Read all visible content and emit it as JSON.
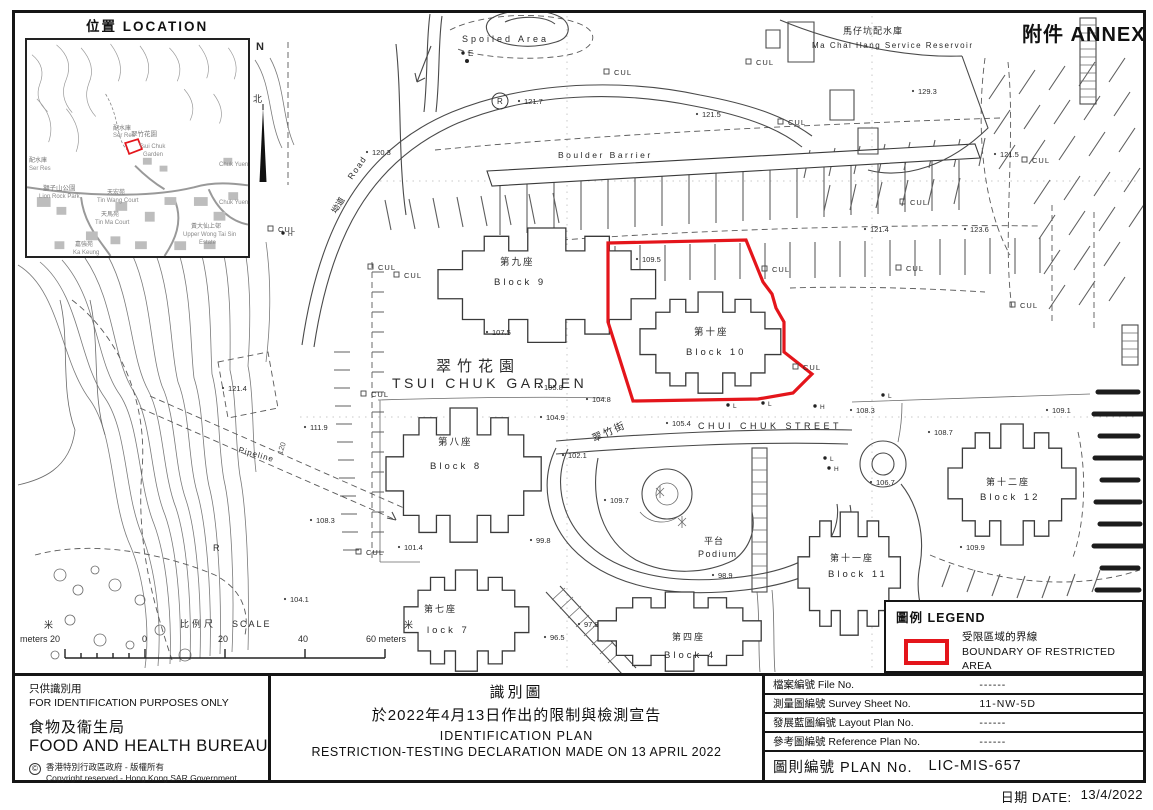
{
  "page": {
    "annex": "附件 ANNEX"
  },
  "location_inset": {
    "title": "位置 LOCATION",
    "north_en": "N",
    "north_zh": "北",
    "labels": [
      {
        "t": "配水庫",
        "x": 86,
        "y": 86,
        "s": 6,
        "c": "#777"
      },
      {
        "t": "Ser Res",
        "x": 86,
        "y": 93,
        "s": 6
      },
      {
        "t": "翠竹花園",
        "x": 104,
        "y": 92,
        "s": 6.5,
        "c": "#777"
      },
      {
        "t": "Tsui Chuk",
        "x": 112,
        "y": 104,
        "s": 6
      },
      {
        "t": "Garden",
        "x": 116,
        "y": 112,
        "s": 6
      },
      {
        "t": "配水庫",
        "x": 2,
        "y": 118,
        "s": 6,
        "c": "#777"
      },
      {
        "t": "Ser Res",
        "x": 2,
        "y": 126,
        "s": 6
      },
      {
        "t": "獅子山公園",
        "x": 16,
        "y": 146,
        "s": 6.5,
        "c": "#777"
      },
      {
        "t": "Lion Rock Park",
        "x": 12,
        "y": 154,
        "s": 6
      },
      {
        "t": "天宏苑",
        "x": 80,
        "y": 150,
        "s": 6,
        "c": "#777"
      },
      {
        "t": "Tin Wang Court",
        "x": 70,
        "y": 158,
        "s": 6
      },
      {
        "t": "天馬苑",
        "x": 74,
        "y": 172,
        "s": 6,
        "c": "#777"
      },
      {
        "t": "Tin Ma Court",
        "x": 68,
        "y": 180,
        "s": 6
      },
      {
        "t": "Chuk Yuen",
        "x": 192,
        "y": 122,
        "s": 6
      },
      {
        "t": "Chuk Yuen",
        "x": 192,
        "y": 160,
        "s": 6
      },
      {
        "t": "黃大仙上邨",
        "x": 164,
        "y": 184,
        "s": 6,
        "c": "#777"
      },
      {
        "t": "Upper Wong Tai Sin",
        "x": 156,
        "y": 192,
        "s": 6
      },
      {
        "t": "Estate",
        "x": 172,
        "y": 200,
        "s": 6
      },
      {
        "t": "嘉強苑",
        "x": 48,
        "y": 202,
        "s": 6,
        "c": "#777"
      },
      {
        "t": "Ka Keung",
        "x": 46,
        "y": 210,
        "s": 6
      }
    ]
  },
  "map": {
    "annotations": [
      {
        "t": "Spoiled Area",
        "x": 462,
        "y": 42,
        "s": 9,
        "ls": 3
      },
      {
        "t": "E",
        "x": 468,
        "y": 56,
        "s": 8,
        "m": "dot"
      },
      {
        "t": "Boulder Barrier",
        "x": 558,
        "y": 158,
        "s": 8.5,
        "ls": 2.5
      },
      {
        "t": "馬仔坑配水庫",
        "x": 843,
        "y": 34,
        "s": 9,
        "ls": 1
      },
      {
        "t": "Ma Chai Hang Service Reservoir",
        "x": 812,
        "y": 48,
        "s": 8,
        "ls": 1.5
      },
      {
        "t": "翠竹花園",
        "x": 436,
        "y": 371,
        "s": 15,
        "ls": 6
      },
      {
        "t": "TSUI CHUK GARDEN",
        "x": 392,
        "y": 388,
        "s": 14,
        "ls": 3.5
      },
      {
        "t": "第九座",
        "x": 500,
        "y": 265,
        "s": 9.5,
        "ls": 2
      },
      {
        "t": "Block 9",
        "x": 494,
        "y": 285,
        "s": 9.5,
        "ls": 3
      },
      {
        "t": "第十座",
        "x": 694,
        "y": 335,
        "s": 9.5,
        "ls": 2
      },
      {
        "t": "Block 10",
        "x": 686,
        "y": 355,
        "s": 9.5,
        "ls": 3
      },
      {
        "t": "第八座",
        "x": 438,
        "y": 445,
        "s": 9.5,
        "ls": 2
      },
      {
        "t": "Block 8",
        "x": 430,
        "y": 469,
        "s": 9.5,
        "ls": 3
      },
      {
        "t": "第七座",
        "x": 424,
        "y": 612,
        "s": 9,
        "ls": 2
      },
      {
        "t": "lock 7",
        "x": 427,
        "y": 633,
        "s": 9.5,
        "ls": 3
      },
      {
        "t": "第四座",
        "x": 672,
        "y": 640,
        "s": 9,
        "ls": 2
      },
      {
        "t": "Block 4",
        "x": 664,
        "y": 658,
        "s": 9.5,
        "ls": 3
      },
      {
        "t": "第十一座",
        "x": 830,
        "y": 561,
        "s": 9,
        "ls": 2
      },
      {
        "t": "Block 11",
        "x": 828,
        "y": 577,
        "s": 9.5,
        "ls": 3
      },
      {
        "t": "第十二座",
        "x": 986,
        "y": 485,
        "s": 9,
        "ls": 2
      },
      {
        "t": "Block 12",
        "x": 980,
        "y": 500,
        "s": 9.5,
        "ls": 3
      },
      {
        "t": "翠竹街",
        "x": 594,
        "y": 442,
        "s": 10,
        "ls": 2,
        "r": -24
      },
      {
        "t": "CHUI CHUK STREET",
        "x": 698,
        "y": 429,
        "s": 9,
        "ls": 3.5
      },
      {
        "t": "平台",
        "x": 704,
        "y": 544,
        "s": 9,
        "ls": 1
      },
      {
        "t": "Podium",
        "x": 698,
        "y": 557,
        "s": 9,
        "ls": 1.5
      },
      {
        "t": "Pipeline",
        "x": 238,
        "y": 452,
        "s": 8,
        "ls": 1,
        "r": 16
      },
      {
        "t": "坳道",
        "x": 336,
        "y": 214,
        "s": 8.5,
        "r": -58
      },
      {
        "t": "Road",
        "x": 352,
        "y": 180,
        "s": 8.5,
        "ls": 1.5,
        "r": -55
      },
      {
        "t": "120",
        "x": 282,
        "y": 455,
        "s": 7.5,
        "r": -72,
        "c": "#555"
      },
      {
        "t": "R",
        "x": 213,
        "y": 551,
        "s": 9
      },
      {
        "t": "R",
        "x": 497,
        "y": 104,
        "s": 8
      },
      {
        "t": "N",
        "x": 256,
        "y": 50,
        "s": 11,
        "w": "bold"
      },
      {
        "t": "北",
        "x": 253,
        "y": 102,
        "s": 9
      },
      {
        "t": "121.7",
        "x": 524,
        "y": 104,
        "s": 7.5,
        "m": "pt"
      },
      {
        "t": "120.3",
        "x": 372,
        "y": 155,
        "s": 7.5,
        "m": "pt"
      },
      {
        "t": "121.5",
        "x": 702,
        "y": 117,
        "s": 7.5,
        "m": "pt"
      },
      {
        "t": "129.3",
        "x": 918,
        "y": 94,
        "s": 7.5,
        "m": "pt"
      },
      {
        "t": "121.5",
        "x": 1000,
        "y": 157,
        "s": 7.5,
        "m": "pt"
      },
      {
        "t": "121.4",
        "x": 870,
        "y": 232,
        "s": 7.5,
        "m": "pt"
      },
      {
        "t": "123.6",
        "x": 970,
        "y": 232,
        "s": 7.5,
        "m": "pt"
      },
      {
        "t": "121.4",
        "x": 228,
        "y": 391,
        "s": 7.5,
        "m": "pt"
      },
      {
        "t": "109.5",
        "x": 642,
        "y": 262,
        "s": 7.5,
        "m": "pt"
      },
      {
        "t": "107.5",
        "x": 492,
        "y": 335,
        "s": 7.5,
        "m": "pt"
      },
      {
        "t": "105.8",
        "x": 544,
        "y": 390,
        "s": 7.5,
        "m": "pt"
      },
      {
        "t": "104.8",
        "x": 592,
        "y": 402,
        "s": 7.5,
        "m": "pt"
      },
      {
        "t": "104.9",
        "x": 546,
        "y": 420,
        "s": 7.5,
        "m": "pt"
      },
      {
        "t": "105.4",
        "x": 672,
        "y": 426,
        "s": 7.5,
        "m": "pt"
      },
      {
        "t": "102.1",
        "x": 568,
        "y": 458,
        "s": 7.5,
        "m": "pt"
      },
      {
        "t": "101.4",
        "x": 404,
        "y": 550,
        "s": 7.5,
        "m": "pt"
      },
      {
        "t": "99.8",
        "x": 536,
        "y": 543,
        "s": 7.5,
        "m": "pt"
      },
      {
        "t": "109.7",
        "x": 610,
        "y": 503,
        "s": 7.5,
        "m": "pt"
      },
      {
        "t": "98.9",
        "x": 718,
        "y": 578,
        "s": 7.5,
        "m": "pt"
      },
      {
        "t": "97.8",
        "x": 584,
        "y": 627,
        "s": 7.5,
        "m": "pt"
      },
      {
        "t": "96.5",
        "x": 550,
        "y": 640,
        "s": 7.5,
        "m": "pt"
      },
      {
        "t": "108.3",
        "x": 856,
        "y": 413,
        "s": 7.5,
        "m": "pt"
      },
      {
        "t": "108.7",
        "x": 934,
        "y": 435,
        "s": 7.5,
        "m": "pt"
      },
      {
        "t": "106.7",
        "x": 876,
        "y": 485,
        "s": 7.5,
        "m": "pt"
      },
      {
        "t": "109.1",
        "x": 1052,
        "y": 413,
        "s": 7.5,
        "m": "pt"
      },
      {
        "t": "109.9",
        "x": 966,
        "y": 550,
        "s": 7.5,
        "m": "pt"
      },
      {
        "t": "104.1",
        "x": 290,
        "y": 602,
        "s": 7.5,
        "m": "pt"
      },
      {
        "t": "111.9",
        "x": 310,
        "y": 430,
        "s": 7.5,
        "m": "pt"
      },
      {
        "t": "108.3",
        "x": 316,
        "y": 523,
        "s": 7.5,
        "m": "pt"
      },
      {
        "t": "CUL",
        "x": 614,
        "y": 75,
        "s": 7.5,
        "ls": 1,
        "m": "sq"
      },
      {
        "t": "CUL",
        "x": 756,
        "y": 65,
        "s": 7.5,
        "ls": 1,
        "m": "sq"
      },
      {
        "t": "CUL",
        "x": 788,
        "y": 125,
        "s": 7.5,
        "ls": 1,
        "m": "sq"
      },
      {
        "t": "CUL",
        "x": 1032,
        "y": 163,
        "s": 7.5,
        "ls": 1,
        "m": "sq"
      },
      {
        "t": "CUL",
        "x": 910,
        "y": 205,
        "s": 7.5,
        "ls": 1,
        "m": "sq"
      },
      {
        "t": "CUL",
        "x": 906,
        "y": 271,
        "s": 7.5,
        "ls": 1,
        "m": "sq"
      },
      {
        "t": "CUL",
        "x": 1020,
        "y": 308,
        "s": 7.5,
        "ls": 1,
        "m": "sq"
      },
      {
        "t": "CUL",
        "x": 378,
        "y": 270,
        "s": 7.5,
        "ls": 1,
        "m": "sq"
      },
      {
        "t": "CUL",
        "x": 404,
        "y": 278,
        "s": 7.5,
        "ls": 1,
        "m": "sq"
      },
      {
        "t": "CUL",
        "x": 772,
        "y": 272,
        "s": 7.5,
        "ls": 1,
        "m": "sq"
      },
      {
        "t": "CUL",
        "x": 803,
        "y": 370,
        "s": 7.5,
        "ls": 1,
        "m": "sq"
      },
      {
        "t": "CUL",
        "x": 371,
        "y": 397,
        "s": 7.5,
        "ls": 1,
        "m": "sq"
      },
      {
        "t": "CUL",
        "x": 366,
        "y": 555,
        "s": 7.5,
        "ls": 1,
        "m": "sq"
      },
      {
        "t": "CUL",
        "x": 278,
        "y": 232,
        "s": 7.5,
        "ls": 1,
        "m": "sq"
      },
      {
        "t": "L",
        "x": 733,
        "y": 408,
        "s": 6.5,
        "m": "dot"
      },
      {
        "t": "L",
        "x": 768,
        "y": 406,
        "s": 6.5,
        "m": "dot"
      },
      {
        "t": "H",
        "x": 820,
        "y": 409,
        "s": 6.5,
        "m": "dot"
      },
      {
        "t": "L",
        "x": 888,
        "y": 398,
        "s": 6.5,
        "m": "dot"
      },
      {
        "t": "L",
        "x": 830,
        "y": 461,
        "s": 6.5,
        "m": "dot"
      },
      {
        "t": "H",
        "x": 834,
        "y": 471,
        "s": 6.5,
        "m": "dot"
      },
      {
        "t": "H",
        "x": 288,
        "y": 236,
        "s": 6.5,
        "m": "dot"
      },
      {
        "t": "比例尺",
        "x": 180,
        "y": 627,
        "s": 9,
        "ls": 3
      },
      {
        "t": "SCALE",
        "x": 232,
        "y": 627,
        "s": 9,
        "ls": 2
      },
      {
        "t": "米",
        "x": 44,
        "y": 628,
        "s": 9
      },
      {
        "t": "meters 20",
        "x": 20,
        "y": 642,
        "s": 9
      },
      {
        "t": "0",
        "x": 142,
        "y": 642,
        "s": 9
      },
      {
        "t": "20",
        "x": 218,
        "y": 642,
        "s": 9
      },
      {
        "t": "40",
        "x": 298,
        "y": 642,
        "s": 9
      },
      {
        "t": "60 meters",
        "x": 366,
        "y": 642,
        "s": 9
      },
      {
        "t": "米",
        "x": 404,
        "y": 628,
        "s": 9
      }
    ]
  },
  "legend": {
    "title": "圖例 LEGEND",
    "item_zh": "受限區域的界線",
    "item_en": "BOUNDARY OF RESTRICTED AREA",
    "boundary_color": "#e4151b"
  },
  "title_block": {
    "disclaimer_zh": "只供識別用",
    "disclaimer_en": "FOR IDENTIFICATION PURPOSES ONLY",
    "bureau_zh": "食物及衞生局",
    "bureau_en": "FOOD AND HEALTH BUREAU",
    "copyright_symbol": "©",
    "copyright_zh": "香港特別行政區政府 - 版權所有",
    "copyright_en": "Copyright reserved - Hong Kong SAR Government",
    "plan_title_zh": "識別圖",
    "plan_subtitle_zh": "於2022年4月13日作出的限制與檢測宣告",
    "plan_title_en": "IDENTIFICATION PLAN",
    "plan_subtitle_en": "RESTRICTION-TESTING DECLARATION MADE ON 13 APRIL 2022",
    "fields": [
      {
        "label": "檔案編號 File No.",
        "value": "------"
      },
      {
        "label": "測量圖編號 Survey Sheet No.",
        "value": "11-NW-5D"
      },
      {
        "label": "發展藍圖編號 Layout Plan No.",
        "value": "------"
      },
      {
        "label": "參考圖編號 Reference Plan No.",
        "value": "------"
      }
    ],
    "plan_no_label": "圖則編號 PLAN No.",
    "plan_no_value": "LIC-MIS-657"
  },
  "date_line": {
    "label": "日期 DATE:",
    "value": "13/4/2022"
  }
}
